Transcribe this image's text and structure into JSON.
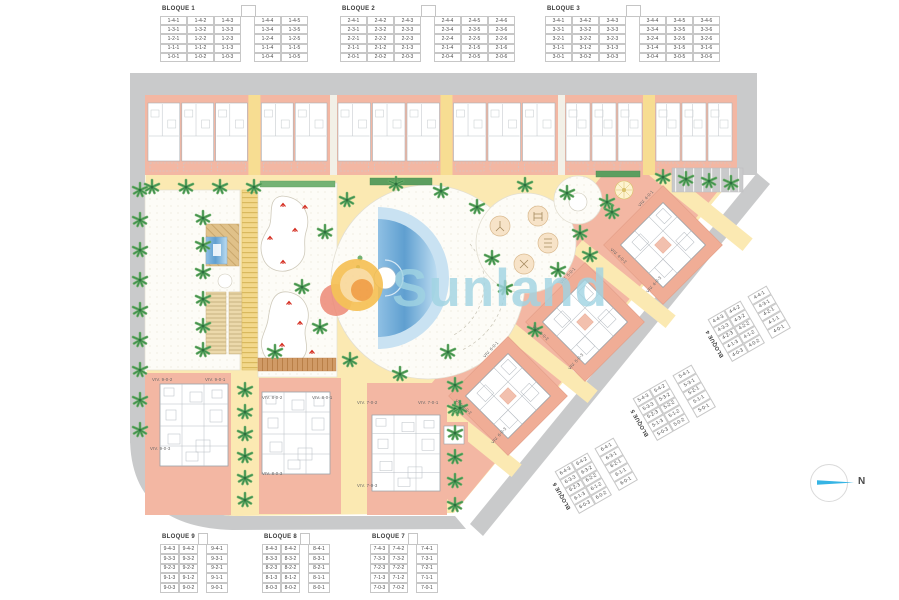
{
  "watermark": {
    "text": "Sunland"
  },
  "compass": {
    "label": "N"
  },
  "colors": {
    "road": "#c9cacb",
    "parcel_path": "#fbe9b2",
    "building_pink": "#f3b7a3",
    "pool_blue": "#6aa9d8",
    "palm_green": "#3e8e4e",
    "watermark_blue": "#a0d4e3",
    "sun_yellow": "#f4bd4c",
    "sun_orange": "#f09c40",
    "sun_red": "#ec8672",
    "north_arrow": "#36b4e4"
  },
  "blocks": {
    "b1": {
      "title": "BLOQUE 1",
      "rows": [
        [
          "1-4-1",
          "1-4-2",
          "1-4-3",
          "",
          "1-4-4",
          "1-4-5"
        ],
        [
          "1-3-1",
          "1-3-2",
          "1-3-3",
          "",
          "1-3-4",
          "1-3-5"
        ],
        [
          "1-2-1",
          "1-2-2",
          "1-2-3",
          "",
          "1-2-4",
          "1-2-5"
        ],
        [
          "1-1-1",
          "1-1-2",
          "1-1-3",
          "",
          "1-1-4",
          "1-1-5"
        ],
        [
          "1-0-1",
          "1-0-2",
          "1-0-3",
          "",
          "1-0-4",
          "1-0-5"
        ]
      ]
    },
    "b2": {
      "title": "BLOQUE 2",
      "rows": [
        [
          "2-4-1",
          "2-4-2",
          "2-4-3",
          "",
          "2-4-4",
          "2-4-5",
          "2-4-6"
        ],
        [
          "2-3-1",
          "2-3-2",
          "2-3-3",
          "",
          "2-3-4",
          "2-3-5",
          "2-3-6"
        ],
        [
          "2-2-1",
          "2-2-2",
          "2-2-3",
          "",
          "2-2-4",
          "2-2-5",
          "2-2-6"
        ],
        [
          "2-1-1",
          "2-1-2",
          "2-1-3",
          "",
          "2-1-4",
          "2-1-5",
          "2-1-6"
        ],
        [
          "2-0-1",
          "2-0-2",
          "2-0-3",
          "",
          "2-0-4",
          "2-0-5",
          "2-0-6"
        ]
      ]
    },
    "b3": {
      "title": "BLOQUE 3",
      "rows": [
        [
          "3-4-1",
          "3-4-2",
          "3-4-3",
          "",
          "3-4-4",
          "3-4-5",
          "3-4-6"
        ],
        [
          "3-3-1",
          "3-3-2",
          "3-3-3",
          "",
          "3-3-4",
          "3-3-5",
          "3-3-6"
        ],
        [
          "3-2-1",
          "3-2-2",
          "3-2-3",
          "",
          "3-2-4",
          "3-2-5",
          "3-2-6"
        ],
        [
          "3-1-1",
          "3-1-2",
          "3-1-3",
          "",
          "3-1-4",
          "3-1-5",
          "3-1-6"
        ],
        [
          "3-0-1",
          "3-0-2",
          "3-0-3",
          "",
          "3-0-4",
          "3-0-5",
          "3-0-6"
        ]
      ]
    },
    "b4": {
      "title": "BLOQUE 4",
      "rows": [
        [
          "4-4-3",
          "4-4-2",
          "",
          "4-4-1"
        ],
        [
          "4-3-3",
          "4-3-2",
          "",
          "4-3-1"
        ],
        [
          "4-2-3",
          "4-2-2",
          "",
          "4-2-1"
        ],
        [
          "4-1-3",
          "4-1-2",
          "",
          "4-1-1"
        ],
        [
          "4-0-3",
          "4-0-2",
          "",
          "4-0-1"
        ]
      ]
    },
    "b5": {
      "title": "BLOQUE 5",
      "rows": [
        [
          "5-4-3",
          "5-4-2",
          "",
          "5-4-1"
        ],
        [
          "5-3-3",
          "5-3-2",
          "",
          "5-3-1"
        ],
        [
          "5-2-3",
          "5-2-2",
          "",
          "5-2-1"
        ],
        [
          "5-1-3",
          "5-1-2",
          "",
          "5-1-1"
        ],
        [
          "5-0-3",
          "5-0-2",
          "",
          "5-0-1"
        ]
      ]
    },
    "b6": {
      "title": "BLOQUE 6",
      "rows": [
        [
          "6-4-3",
          "6-4-2",
          "",
          "6-4-1"
        ],
        [
          "6-3-3",
          "6-3-2",
          "",
          "6-3-1"
        ],
        [
          "6-2-3",
          "6-2-2",
          "",
          "6-2-1"
        ],
        [
          "6-1-3",
          "6-1-2",
          "",
          "6-1-1"
        ],
        [
          "6-0-3",
          "6-0-2",
          "",
          "6-0-1"
        ]
      ]
    },
    "b7": {
      "title": "BLOQUE 7",
      "rows": [
        [
          "7-4-3",
          "7-4-2",
          "",
          "7-4-1"
        ],
        [
          "7-3-3",
          "7-3-2",
          "",
          "7-3-1"
        ],
        [
          "7-2-3",
          "7-2-2",
          "",
          "7-2-1"
        ],
        [
          "7-1-3",
          "7-1-2",
          "",
          "7-1-1"
        ],
        [
          "7-0-3",
          "7-0-2",
          "",
          "7-0-1"
        ]
      ]
    },
    "b8": {
      "title": "BLOQUE 8",
      "rows": [
        [
          "8-4-3",
          "8-4-2",
          "",
          "8-4-1"
        ],
        [
          "8-3-3",
          "8-3-2",
          "",
          "8-3-1"
        ],
        [
          "8-2-3",
          "8-2-2",
          "",
          "8-2-1"
        ],
        [
          "8-1-3",
          "8-1-2",
          "",
          "8-1-1"
        ],
        [
          "8-0-3",
          "8-0-2",
          "",
          "8-0-1"
        ]
      ]
    },
    "b9": {
      "title": "BLOQUE 9",
      "rows": [
        [
          "9-4-3",
          "9-4-2",
          "",
          "9-4-1"
        ],
        [
          "9-3-3",
          "9-3-2",
          "",
          "9-3-1"
        ],
        [
          "9-2-3",
          "9-2-2",
          "",
          "9-2-1"
        ],
        [
          "9-1-3",
          "9-1-2",
          "",
          "9-1-1"
        ],
        [
          "9-0-3",
          "9-0-2",
          "",
          "9-0-1"
        ]
      ]
    }
  },
  "viv": {
    "b4": [
      "VIV. 4-0-1",
      "VIV. 4-0-2",
      "VIV. 4-0-3"
    ],
    "b5": [
      "VIV. 5-0-1",
      "VIV. 5-0-2",
      "VIV. 5-0-3"
    ],
    "b6": [
      "VIV. 6-0-1",
      "VIV. 6-0-2",
      "VIV. 6-0-3"
    ],
    "b7": [
      "VIV. 7-0-1",
      "VIV. 7-0-2",
      "VIV. 7-0-3"
    ],
    "b8": [
      "VIV. 8-0-1",
      "VIV. 8-0-2",
      "VIV. 8-0-3"
    ],
    "b9": [
      "VIV. 9-0-1",
      "VIV. 9-0-2",
      "VIV. 9-0-3"
    ]
  }
}
